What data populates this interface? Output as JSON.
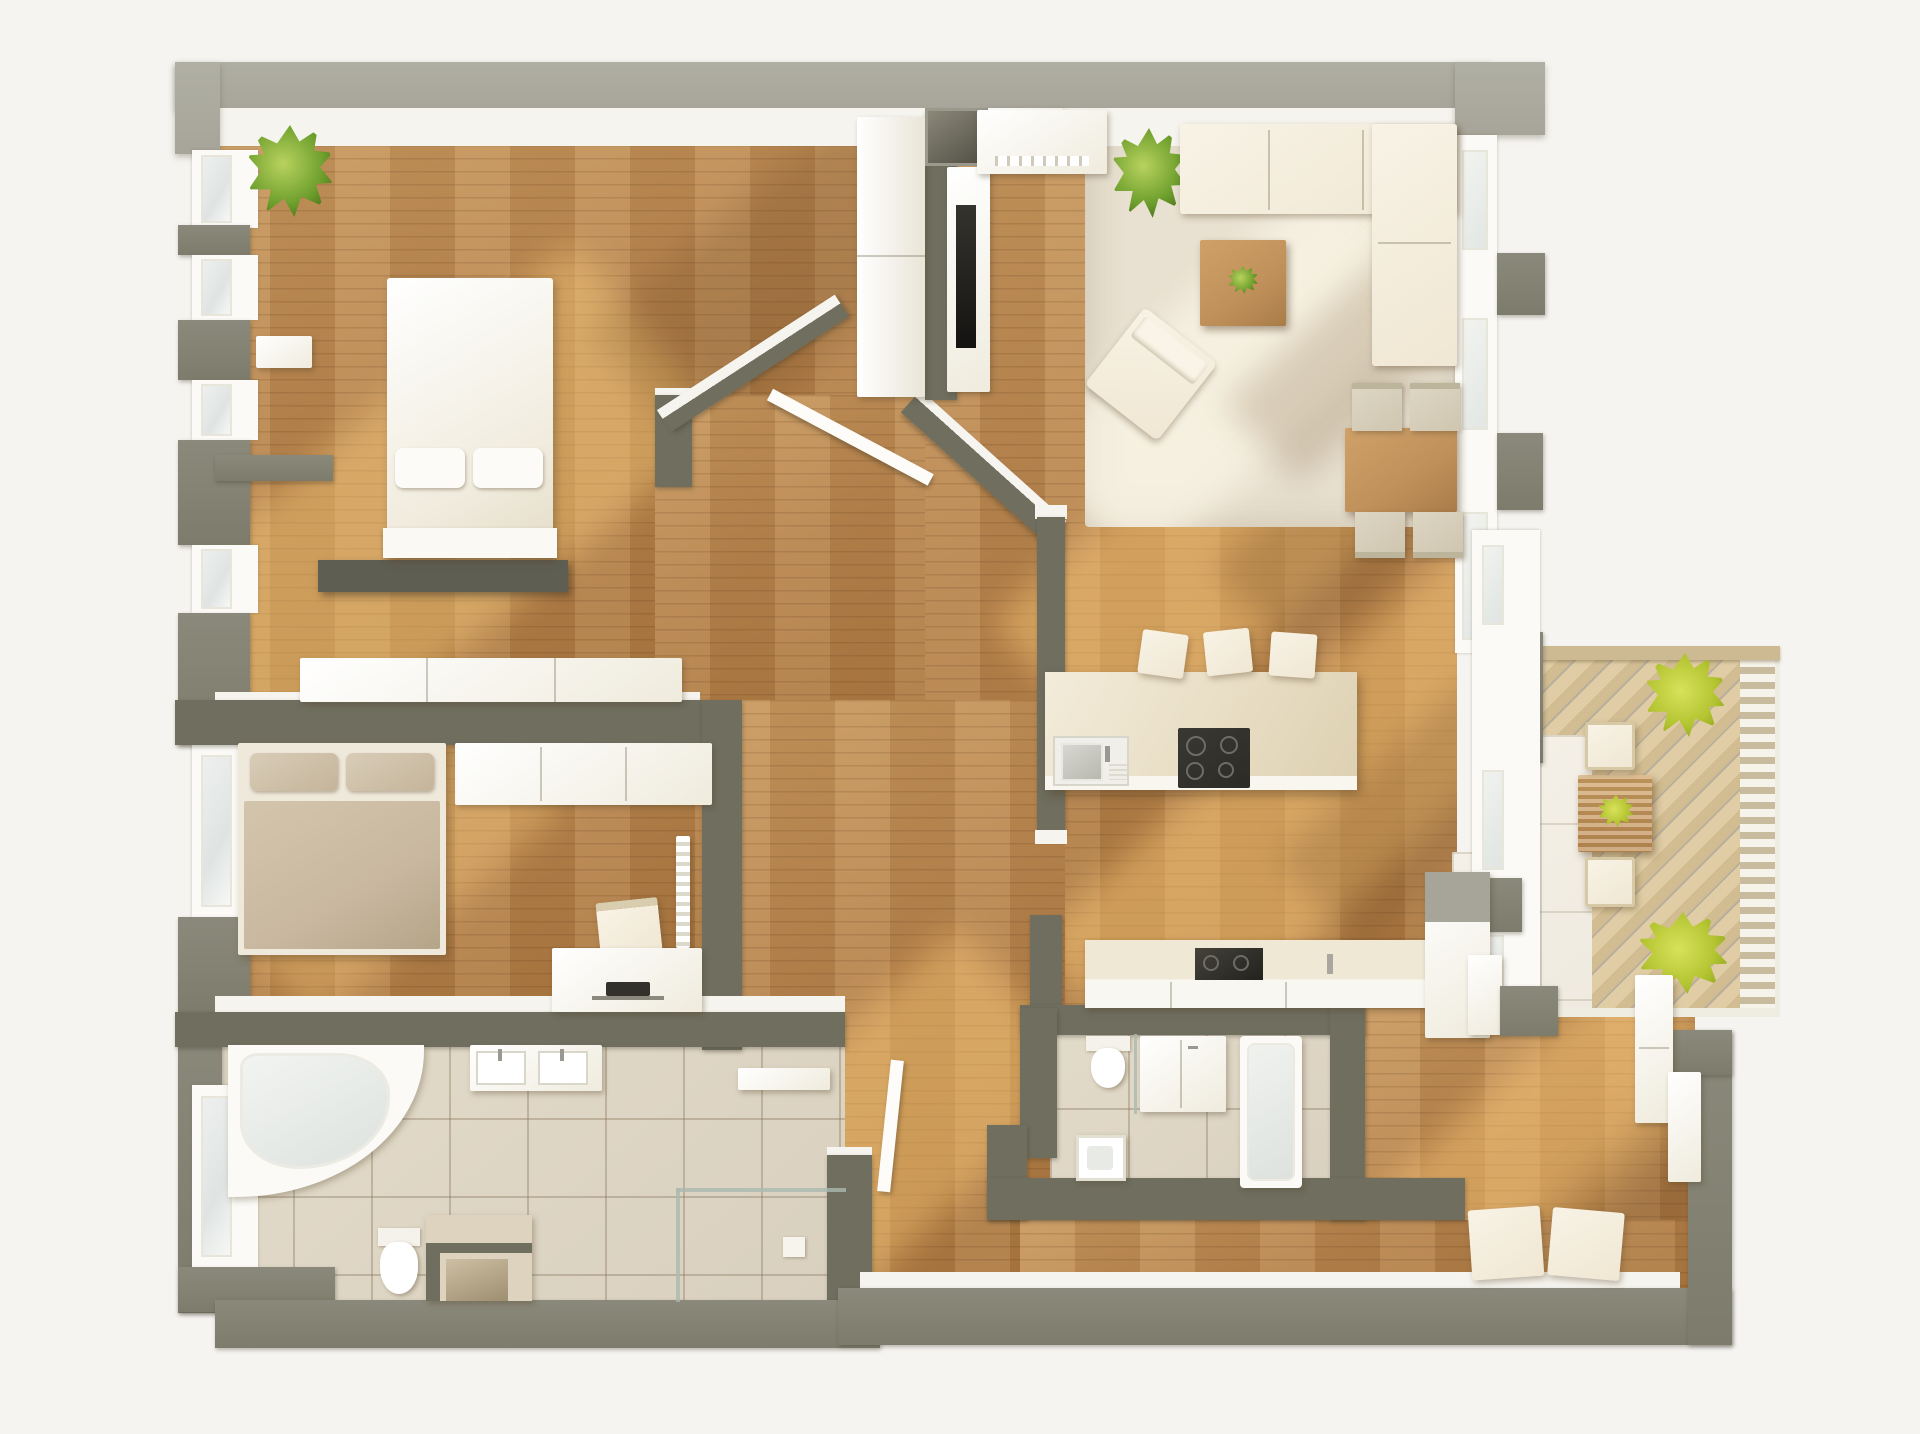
{
  "scene": {
    "kind": "apartment-floor-plan-3d-render",
    "view": "top-down",
    "text_visible": "none"
  },
  "palette": {
    "bg": "#f6f4f0",
    "wallOuter": "#a7a599",
    "wall": "#7d7c6c",
    "wallDark": "#6f6e5f",
    "white": "#f6f4ee",
    "wood": "#b5824c",
    "woodLight": "#c8985f",
    "carpet": "#e8e0d0",
    "tile": "#d9d0bf",
    "tileWhite": "#efeadf",
    "deck": "#e0cda5",
    "railing": "#c9bc9e",
    "cream": "#f0e7d3",
    "beige": "#cfc6b0",
    "bedTaupe": "#c9b8a0",
    "green": "#6fa02e",
    "lime": "#b3c431",
    "dark": "#2d2b27",
    "tableWood": "#c0905a",
    "sun": "#ffd280",
    "shadow": "#6e4a22"
  },
  "rooms": [
    {
      "name": "bedroom-1",
      "furniture": [
        "double-bed",
        "two-pillows",
        "headboard-bench",
        "sideboard",
        "wall-shelf",
        "wardrobe-column",
        "potted-plant"
      ]
    },
    {
      "name": "living-room",
      "furniture": [
        "corner-sofa",
        "coffee-table-with-plant",
        "armchair",
        "dining-table",
        "four-dining-chairs",
        "rug",
        "tv-panel",
        "media-cabinet",
        "potted-plant",
        "wall-niche",
        "closet"
      ]
    },
    {
      "name": "kitchen",
      "furniture": [
        "island-with-sink-and-cooktop",
        "three-bar-stools",
        "wall-counter-with-sink",
        "tall-cabinet"
      ]
    },
    {
      "name": "bedroom-2",
      "furniture": [
        "double-bed",
        "two-pillows",
        "wardrobe-row",
        "desk",
        "monitor",
        "desk-chair",
        "radiator-shelf"
      ]
    },
    {
      "name": "bathroom-1",
      "furniture": [
        "corner-bathtub",
        "double-sink-vanity",
        "wall-shelf",
        "toilet",
        "storage-bench",
        "glass-shower",
        "window"
      ]
    },
    {
      "name": "bathroom-2",
      "furniture": [
        "toilet",
        "cabinet-washer",
        "bathtub",
        "square-sink"
      ]
    },
    {
      "name": "hallway",
      "furniture": [
        "angled-walls",
        "open-door-leaf"
      ]
    },
    {
      "name": "entry",
      "furniture": [
        "two-pouf-cubes",
        "wardrobe-cabinets",
        "storage-blocks"
      ]
    },
    {
      "name": "balcony",
      "furniture": [
        "slatted-deck",
        "railing",
        "outdoor-table-with-plant",
        "two-outdoor-chairs",
        "two-potted-plants"
      ]
    }
  ]
}
